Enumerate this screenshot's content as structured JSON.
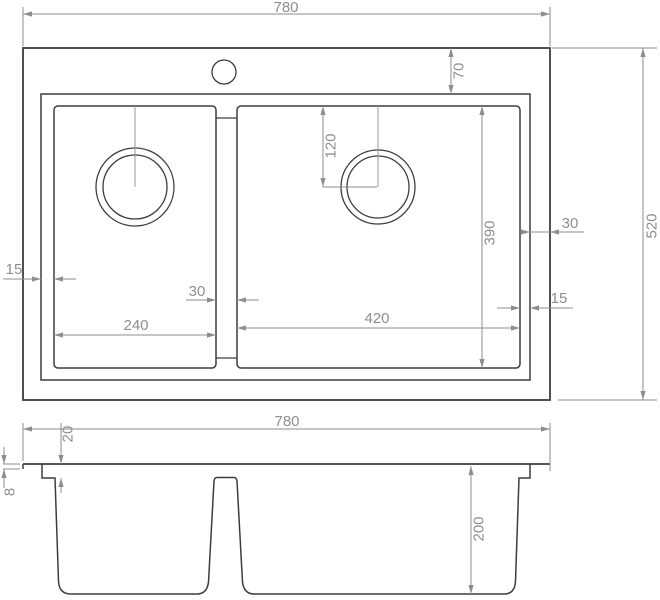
{
  "drawing": {
    "type": "technical-dimension-drawing",
    "subject": "double-bowl kitchen sink, plan view and front section view",
    "units_implied": "mm",
    "canvas": {
      "width": 660,
      "height": 600,
      "background": "#ffffff"
    },
    "colors": {
      "object_line": "#3d3d3d",
      "dimension_line": "#8e8e8e",
      "dimension_text": "#8e8e8e",
      "centerline": "#9a9a9a"
    },
    "views": {
      "plan": {
        "outer_rect": [
          23,
          48,
          527,
          352
        ],
        "rim_rect": [
          41,
          94,
          489,
          286
        ],
        "left_bowl_rect": [
          54,
          106,
          162,
          262
        ],
        "right_bowl_rect": [
          237,
          106,
          283,
          262
        ],
        "bowl_corner_radius": 4,
        "divider_bridge_top": [
          216,
          118,
          237,
          118
        ],
        "divider_bridge_bottom": [
          216,
          358,
          237,
          358
        ],
        "faucet_hole": {
          "cx": 224,
          "cy": 72,
          "r": 12
        },
        "left_drain": {
          "cx": 135,
          "cy": 187,
          "r_outer": 39,
          "r_inner": 32
        },
        "right_drain": {
          "cx": 378,
          "cy": 187,
          "r_outer": 37,
          "r_inner": 31
        },
        "centerlines": [
          [
            135,
            106,
            135,
            187
          ],
          [
            378,
            106,
            378,
            187
          ]
        ]
      },
      "front": {
        "deck_line": [
          23,
          464,
          550,
          464
        ],
        "edge_lip_line": [
          23,
          464,
          23,
          469
        ],
        "profile_path": "M 42 464 L 42 478 L 55 478 L 58.5 581 Q 59 594 71 594 L 197 594 Q 207 594 208.5 582 L 214 481 Q 214.5 477.5 217 477.5 L 234 477.5 Q 236.5 477.5 237 481 L 242.5 582 Q 244 594 254 594 L 504 594 Q 515 594 515.5 581 L 519 478 L 530 478 L 530 464"
      }
    },
    "dimensions": [
      {
        "id": "overall-width-top",
        "label": "780",
        "rotated": false,
        "label_pos": [
          286,
          12
        ],
        "lines": [
          [
            23,
            14,
            550,
            14
          ],
          [
            23,
            7,
            23,
            46
          ],
          [
            550,
            7,
            550,
            46
          ]
        ],
        "arrows": [
          [
            23,
            14,
            "l"
          ],
          [
            550,
            14,
            "r"
          ]
        ]
      },
      {
        "id": "rim-offset-top",
        "label": "70",
        "rotated": true,
        "label_pos": [
          459,
          71
        ],
        "lines": [
          [
            451,
            48,
            451,
            94
          ]
        ],
        "arrows": [
          [
            451,
            48,
            "u"
          ],
          [
            451,
            94,
            "d"
          ]
        ]
      },
      {
        "id": "drain-offset-from-bowl-top",
        "label": "120",
        "rotated": true,
        "label_pos": [
          331,
          146
        ],
        "lines": [
          [
            323,
            106,
            323,
            187
          ],
          [
            323,
            187,
            377,
            187
          ]
        ],
        "arrows": [
          [
            323,
            106,
            "u"
          ],
          [
            323,
            187,
            "d"
          ]
        ]
      },
      {
        "id": "bowl-length",
        "label": "390",
        "rotated": true,
        "label_pos": [
          490,
          233
        ],
        "lines": [
          [
            482,
            106,
            482,
            368
          ]
        ],
        "arrows": [
          [
            482,
            106,
            "u"
          ],
          [
            482,
            368,
            "d"
          ]
        ]
      },
      {
        "id": "overall-depth",
        "label": "520",
        "rotated": true,
        "label_pos": [
          652,
          226
        ],
        "lines": [
          [
            643,
            48,
            643,
            400
          ],
          [
            552,
            48,
            657,
            48
          ],
          [
            558,
            400,
            657,
            400
          ]
        ],
        "arrows": [
          [
            643,
            48,
            "u"
          ],
          [
            643,
            400,
            "d"
          ]
        ]
      },
      {
        "id": "rim-to-bowl-left",
        "label": "15",
        "rotated": false,
        "label_pos": [
          14,
          274
        ],
        "lines": [
          [
            3,
            279,
            41,
            279
          ],
          [
            54,
            279,
            76,
            279
          ]
        ],
        "arrows": [
          [
            41,
            279,
            "r"
          ],
          [
            54,
            279,
            "l"
          ]
        ]
      },
      {
        "id": "divider-width",
        "label": "30",
        "rotated": false,
        "label_pos": [
          197,
          296
        ],
        "lines": [
          [
            186,
            300,
            216,
            300
          ],
          [
            237,
            300,
            259,
            300
          ]
        ],
        "arrows": [
          [
            216,
            300,
            "r"
          ],
          [
            237,
            300,
            "l"
          ]
        ]
      },
      {
        "id": "left-bowl-width",
        "label": "240",
        "rotated": false,
        "label_pos": [
          136,
          330
        ],
        "lines": [
          [
            54,
            335,
            216,
            335
          ]
        ],
        "arrows": [
          [
            54,
            335,
            "l"
          ],
          [
            216,
            335,
            "r"
          ]
        ]
      },
      {
        "id": "right-bowl-width",
        "label": "420",
        "rotated": false,
        "label_pos": [
          377,
          323
        ],
        "lines": [
          [
            237,
            328,
            520,
            328
          ]
        ],
        "arrows": [
          [
            237,
            328,
            "l"
          ],
          [
            520,
            328,
            "r"
          ]
        ]
      },
      {
        "id": "bowl-to-rim-right",
        "label": "15",
        "rotated": false,
        "label_pos": [
          559,
          303
        ],
        "lines": [
          [
            497,
            308,
            520,
            308
          ],
          [
            530,
            308,
            573,
            308
          ]
        ],
        "arrows": [
          [
            520,
            308,
            "r"
          ],
          [
            530,
            308,
            "l"
          ]
        ]
      },
      {
        "id": "rim-to-edge-right",
        "label": "30",
        "rotated": false,
        "label_pos": [
          570,
          228
        ],
        "lines": [
          [
            521,
            232,
            584,
            232
          ]
        ],
        "arrows": [
          [
            530,
            232,
            "r"
          ],
          [
            550,
            232,
            "l"
          ]
        ]
      },
      {
        "id": "overall-width-front",
        "label": "780",
        "rotated": false,
        "label_pos": [
          287,
          426
        ],
        "lines": [
          [
            23,
            429,
            550,
            429
          ],
          [
            23,
            423,
            23,
            461
          ],
          [
            550,
            423,
            550,
            471
          ]
        ],
        "arrows": [
          [
            23,
            429,
            "l"
          ],
          [
            550,
            429,
            "r"
          ]
        ]
      },
      {
        "id": "rim-height",
        "label": "20",
        "rotated": true,
        "label_pos": [
          68,
          434
        ],
        "lines": [
          [
            61,
            423,
            61,
            464
          ],
          [
            61,
            493,
            61,
            478
          ]
        ],
        "arrows": [
          [
            61,
            464,
            "d"
          ],
          [
            61,
            478,
            "u"
          ]
        ]
      },
      {
        "id": "edge-lip-height",
        "label": "8",
        "rotated": true,
        "label_pos": [
          10,
          492
        ],
        "lines": [
          [
            4,
            447,
            4,
            464
          ],
          [
            4,
            488,
            4,
            469
          ],
          [
            3,
            464,
            20,
            464
          ],
          [
            3,
            469,
            20,
            469
          ]
        ],
        "arrows": [
          [
            4,
            464,
            "d"
          ],
          [
            4,
            469,
            "u"
          ]
        ]
      },
      {
        "id": "bowl-depth",
        "label": "200",
        "rotated": true,
        "label_pos": [
          479,
          529
        ],
        "lines": [
          [
            471,
            466,
            471,
            594
          ]
        ],
        "arrows": [
          [
            471,
            466,
            "u"
          ],
          [
            471,
            594,
            "d"
          ]
        ]
      }
    ]
  }
}
